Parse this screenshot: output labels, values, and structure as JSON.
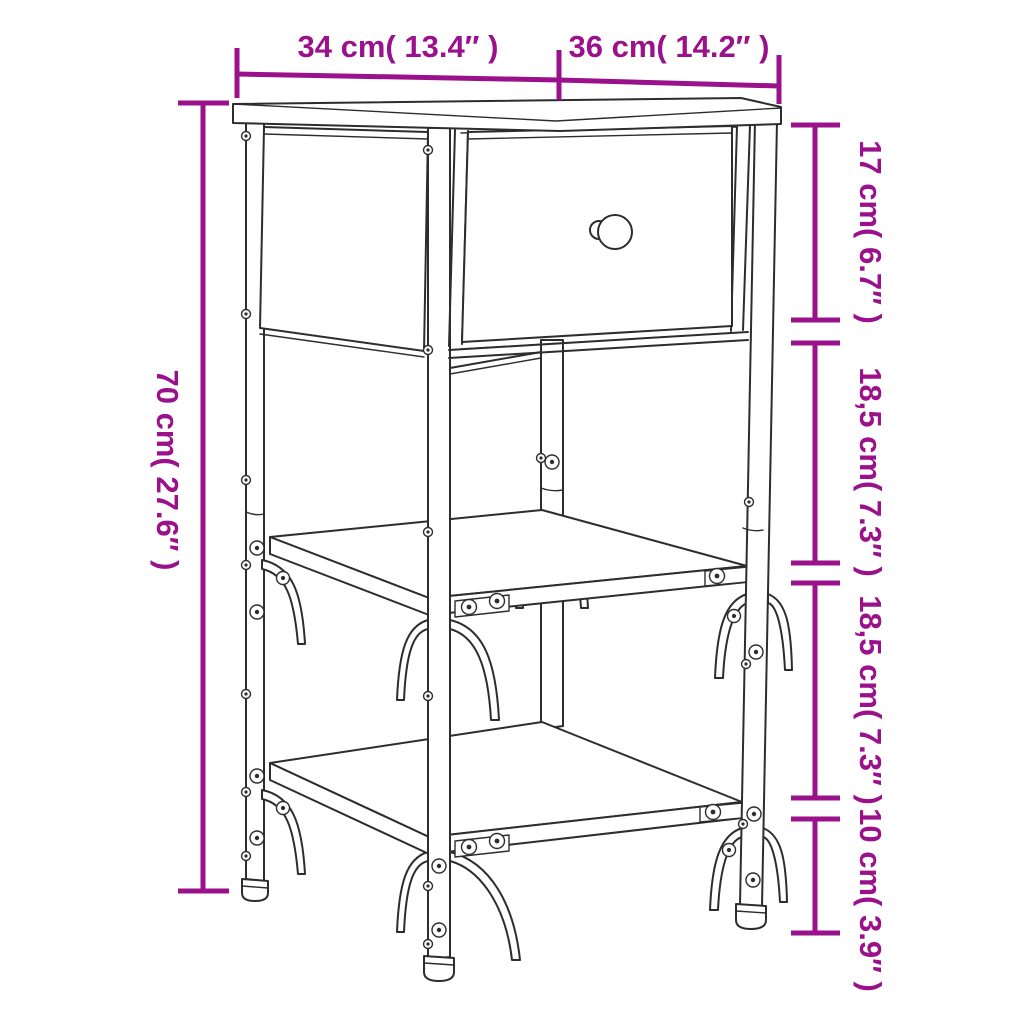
{
  "diagram": {
    "kind": "furniture-dimension-line-drawing",
    "subject": "bedside table with one drawer and two open shelves",
    "background_color": "#ffffff",
    "drawing_line_color": "#2d2d2d",
    "dimension_color": "#9a118b",
    "dimensions": {
      "top_width": "34 cm( 13.4″ )",
      "top_depth": "36 cm( 14.2″ )",
      "overall_height": "70 cm( 27.6″ )",
      "drawer_section_height": "17 cm( 6.7″ )",
      "middle_gap_height": "18,5 cm( 7.3″ )",
      "lower_gap_height": "18,5 cm( 7.3″ )",
      "ground_clearance": "10 cm( 3.9″ )"
    }
  }
}
